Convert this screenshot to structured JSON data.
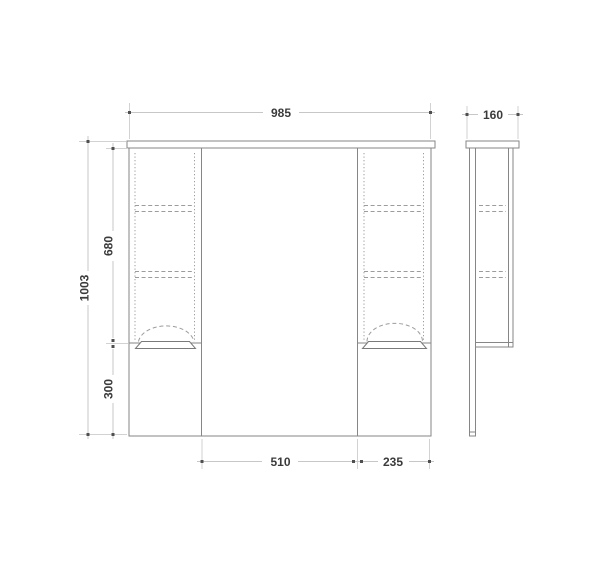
{
  "drawing": {
    "kind": "cabinet-dimension-drawing",
    "dimensions_mm": {
      "overall_width": "985",
      "depth": "160",
      "overall_height": "1003",
      "upper_cabinet_height": "680",
      "lower_section_height": "300",
      "mirror_width": "510",
      "right_cabinet_width": "235"
    },
    "colors": {
      "background": "#ffffff",
      "outline": "#868686",
      "hidden_line": "#9c9c9c",
      "dimension_line": "#c7c7c7",
      "extension_line": "#d2d2d2",
      "arrow": "#4f4f4f",
      "text": "#3b3b3b"
    }
  }
}
